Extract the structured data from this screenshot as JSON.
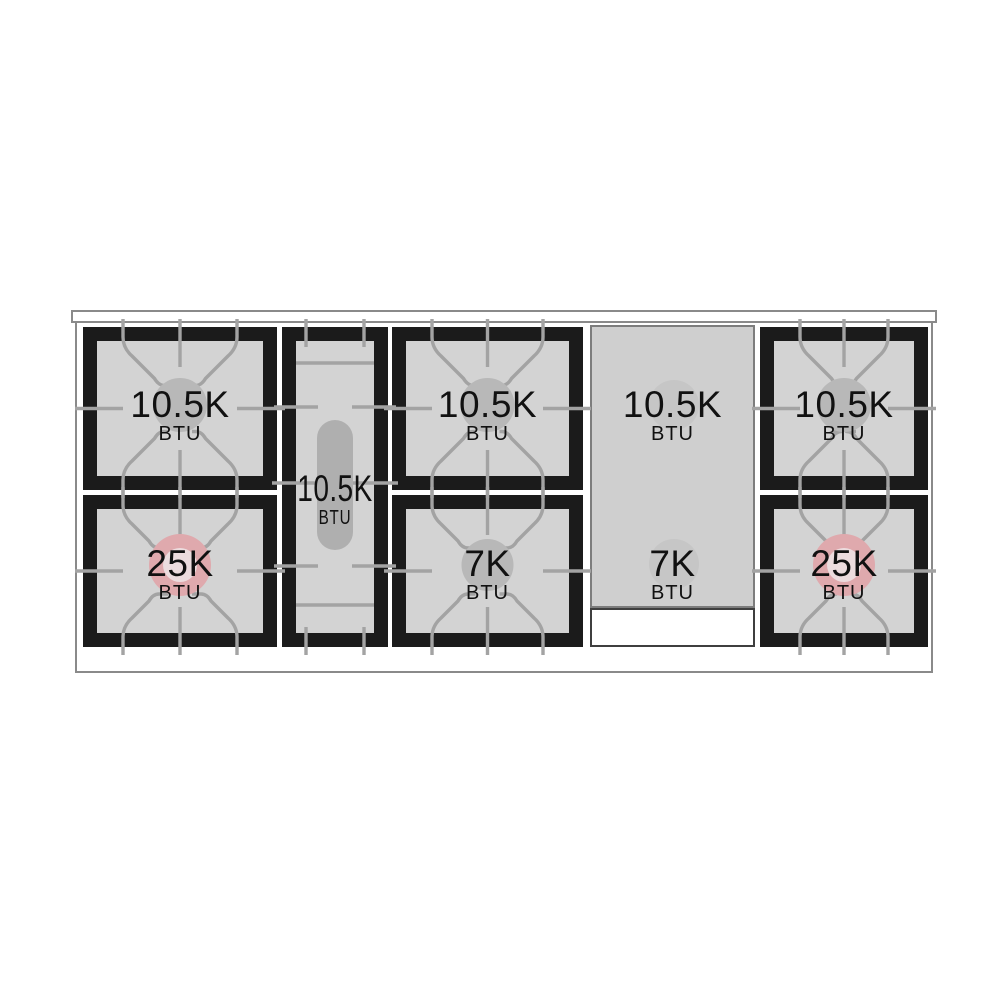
{
  "diagram_label": "gas range top burner power diagram",
  "colors": {
    "surface": "#d3d3d3",
    "frame": "#1b1b1b",
    "grate_lines": "#a3a3a3",
    "burner_circle": "#b8b8b8",
    "power_burner": "#dfa9ad",
    "power_burner_center": "#ecdcde",
    "griddle": "#cfcfcf",
    "griddle_border": "#7d7d7d",
    "griddle_circle": "#c6c6c6",
    "oval_burner": "#afafaf",
    "outline": "#8a8a8a",
    "tray_border": "#3f3f3f",
    "text": "#111111"
  },
  "burners": [
    {
      "id": "left-rear",
      "power": "10.5K",
      "unit": "BTU",
      "type": "standard"
    },
    {
      "id": "left-front",
      "power": "25K",
      "unit": "BTU",
      "type": "power"
    },
    {
      "id": "center-oval",
      "power": "10.5K",
      "unit": "BTU",
      "type": "oval"
    },
    {
      "id": "middle-rear",
      "power": "10.5K",
      "unit": "BTU",
      "type": "standard"
    },
    {
      "id": "middle-front",
      "power": "7K",
      "unit": "BTU",
      "type": "standard"
    },
    {
      "id": "griddle-rear",
      "power": "10.5K",
      "unit": "BTU",
      "type": "griddle"
    },
    {
      "id": "griddle-front",
      "power": "7K",
      "unit": "BTU",
      "type": "griddle"
    },
    {
      "id": "right-rear",
      "power": "10.5K",
      "unit": "BTU",
      "type": "standard"
    },
    {
      "id": "right-front",
      "power": "25K",
      "unit": "BTU",
      "type": "power"
    }
  ]
}
